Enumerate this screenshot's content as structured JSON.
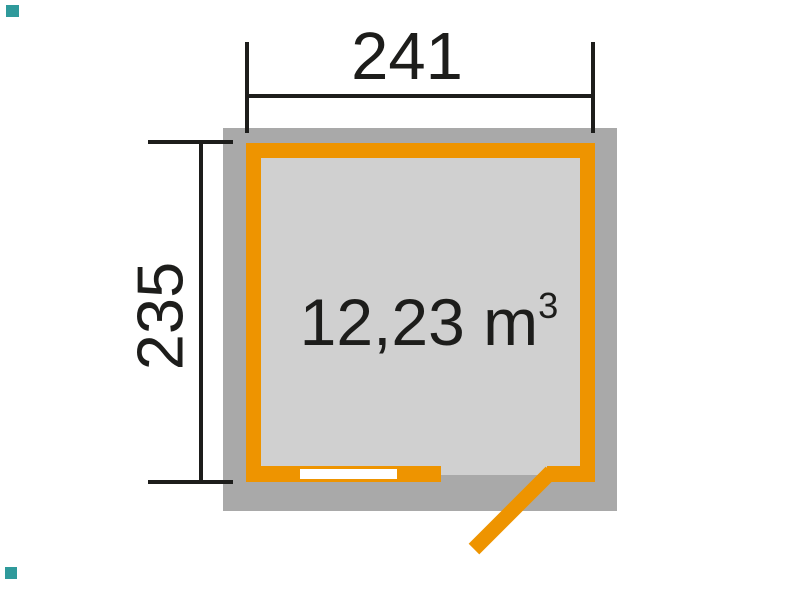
{
  "plan": {
    "width_dimension": "241",
    "height_dimension": "235",
    "volume_value": "12,23 m",
    "volume_superscript": "3"
  },
  "colors": {
    "wall_orange": "#ee9400",
    "overhang_gray": "#a9a9a9",
    "interior_gray": "#d0d0d0",
    "dimension_line_black": "#1d1d1b",
    "window_white": "#ffffff",
    "brand_teal": "#2f9a9b"
  }
}
